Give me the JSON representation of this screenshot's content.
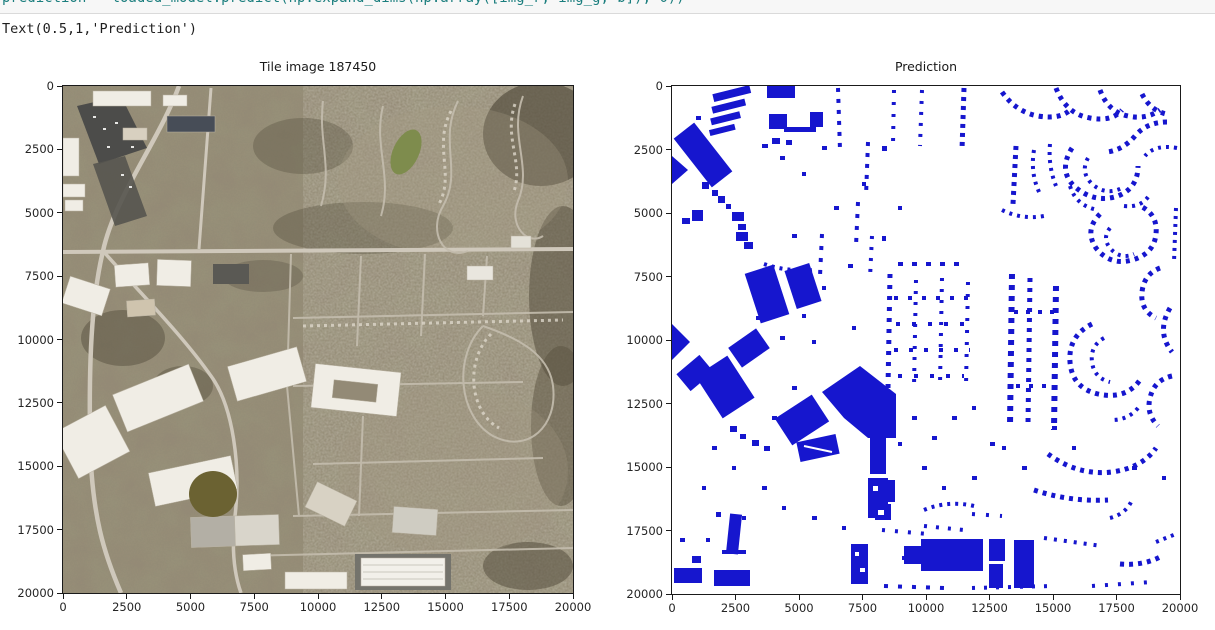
{
  "page": {
    "background": "#ffffff"
  },
  "code_cell": {
    "clipped_source": "prediction = loaded_model.predict(np.expand_dims(np.array([img_r, img_g, b]), 0))",
    "output_text": "Text(0.5,1,'Prediction')"
  },
  "figure": {
    "tick_labels": [
      "0",
      "2500",
      "5000",
      "7500",
      "10000",
      "12500",
      "15000",
      "17500",
      "20000"
    ],
    "axis_range": [
      0,
      20000
    ],
    "plots": [
      {
        "title": "Tile image 187450",
        "type": "satellite-tile-image"
      },
      {
        "title": "Prediction",
        "type": "binary-building-mask"
      }
    ],
    "colors": {
      "prediction_blue": "#1616ce",
      "axis_color": "#1a1a1a",
      "code_teal": "#1b7e7e",
      "mask_background": "#ffffff"
    }
  }
}
